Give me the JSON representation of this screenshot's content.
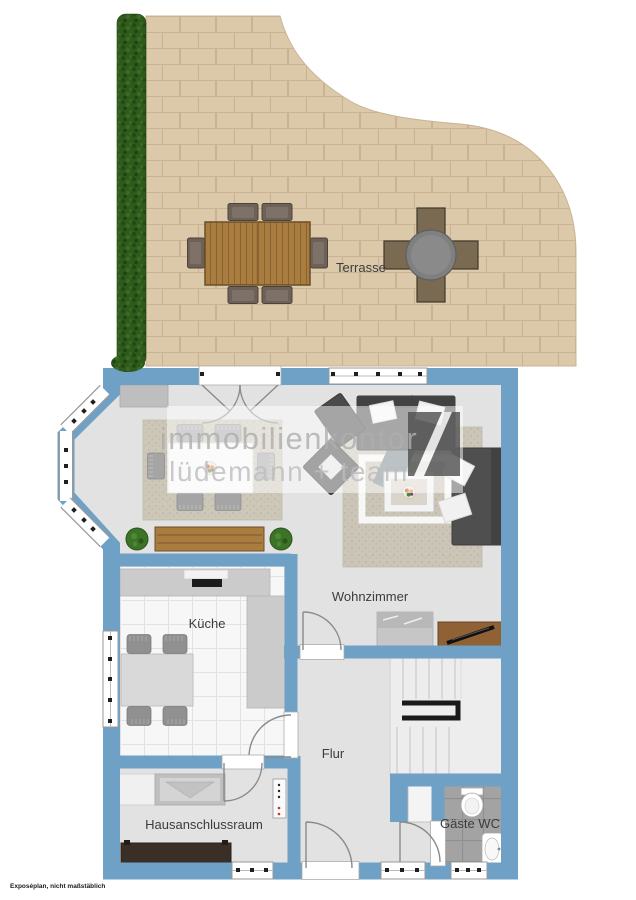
{
  "disclaimer": "Exposéplan, nicht maßstäblich",
  "watermark": {
    "line1": "immobilienkontor",
    "line2": "lüdemann + team",
    "logo": "dark-square-diagonal-stripe"
  },
  "room_labels": {
    "terrace": "Terrasse",
    "living_room": "Wohnzimmer",
    "kitchen": "Küche",
    "hallway": "Flur",
    "utility_room": "Hausanschlussraum",
    "guest_wc": "Gäste WC"
  },
  "colors": {
    "wall": "#6FA0C5",
    "floor": "#E2E2E2",
    "terrace_tile": "#DCC9A9",
    "terrace_grout": "#C9B394",
    "hedge": "#2E5A1D",
    "kitchen_floor": "#F7F7F7",
    "wc_floor": "#A3A3A3",
    "wood_furniture": "#A97C3F",
    "sofa": "#4F4F4F",
    "rug": "#CDC7B8",
    "stair_railing": "#1A1A1A"
  }
}
